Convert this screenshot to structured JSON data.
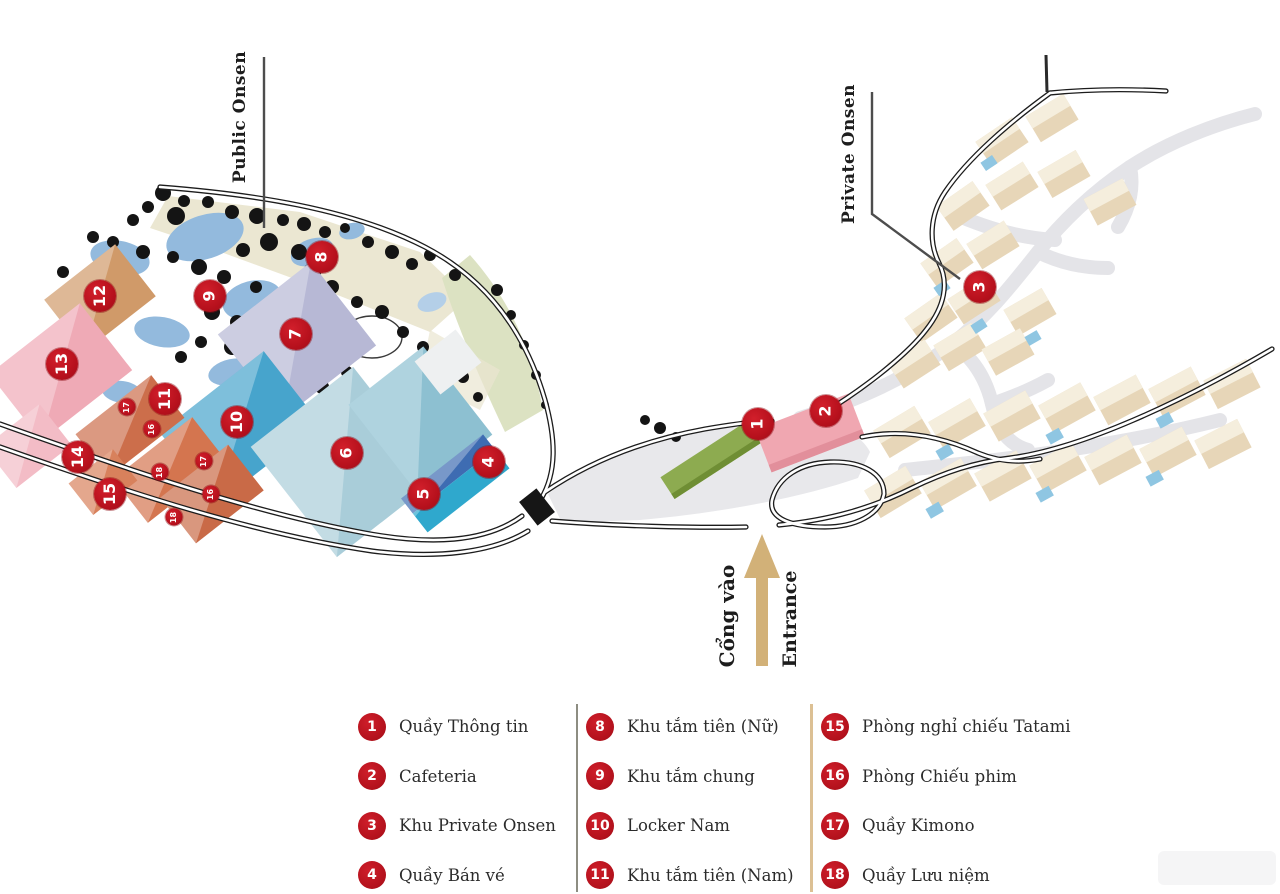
{
  "map": {
    "labels": {
      "public_onsen": "Public Onsen",
      "private_onsen": "Private Onsen",
      "entrance_vi": "Cổng vào",
      "entrance_en": "Entrance"
    },
    "colors": {
      "marker_red": "#b5101c",
      "entrance_arrow_tan": "#d2b178",
      "road_black": "#1c1c1c",
      "path_gray": "#e4e4e8",
      "pond_blue": "#93badd",
      "villa_beige": "#e7d6b8"
    },
    "markers": [
      {
        "n": "1",
        "x": 758,
        "y": 424,
        "size": "large"
      },
      {
        "n": "2",
        "x": 826,
        "y": 411,
        "size": "large"
      },
      {
        "n": "3",
        "x": 980,
        "y": 287,
        "size": "large"
      },
      {
        "n": "4",
        "x": 489,
        "y": 462,
        "size": "large"
      },
      {
        "n": "5",
        "x": 424,
        "y": 494,
        "size": "large"
      },
      {
        "n": "6",
        "x": 347,
        "y": 453,
        "size": "large"
      },
      {
        "n": "7",
        "x": 296,
        "y": 334,
        "size": "large"
      },
      {
        "n": "8",
        "x": 322,
        "y": 257,
        "size": "large"
      },
      {
        "n": "9",
        "x": 210,
        "y": 296,
        "size": "large"
      },
      {
        "n": "10",
        "x": 237,
        "y": 422,
        "size": "large"
      },
      {
        "n": "11",
        "x": 165,
        "y": 399,
        "size": "large"
      },
      {
        "n": "12",
        "x": 100,
        "y": 296,
        "size": "large"
      },
      {
        "n": "13",
        "x": 62,
        "y": 364,
        "size": "large"
      },
      {
        "n": "14",
        "x": 78,
        "y": 457,
        "size": "large"
      },
      {
        "n": "15",
        "x": 110,
        "y": 494,
        "size": "large"
      },
      {
        "n": "17",
        "x": 127,
        "y": 407,
        "size": "small"
      },
      {
        "n": "16",
        "x": 152,
        "y": 429,
        "size": "small"
      },
      {
        "n": "18",
        "x": 160,
        "y": 472,
        "size": "small"
      },
      {
        "n": "17",
        "x": 204,
        "y": 461,
        "size": "small"
      },
      {
        "n": "16",
        "x": 211,
        "y": 494,
        "size": "small"
      },
      {
        "n": "18",
        "x": 174,
        "y": 517,
        "size": "small"
      }
    ]
  },
  "legend": {
    "columns": [
      {
        "items": [
          {
            "n": "1",
            "label": "Quầy Thông tin"
          },
          {
            "n": "2",
            "label": "Cafeteria"
          },
          {
            "n": "3",
            "label": "Khu Private Onsen"
          },
          {
            "n": "4",
            "label": "Quầy Bán vé"
          }
        ]
      },
      {
        "items": [
          {
            "n": "8",
            "label": "Khu tắm tiên (Nữ)"
          },
          {
            "n": "9",
            "label": "Khu tắm chung"
          },
          {
            "n": "10",
            "label": "Locker Nam"
          },
          {
            "n": "11",
            "label": "Khu tắm tiên (Nam)"
          }
        ]
      },
      {
        "items": [
          {
            "n": "15",
            "label": "Phòng nghỉ chiếu Tatami"
          },
          {
            "n": "16",
            "label": "Phòng Chiếu phim"
          },
          {
            "n": "17",
            "label": "Quầy Kimono"
          },
          {
            "n": "18",
            "label": "Quầy Lưu niệm"
          }
        ]
      }
    ]
  }
}
